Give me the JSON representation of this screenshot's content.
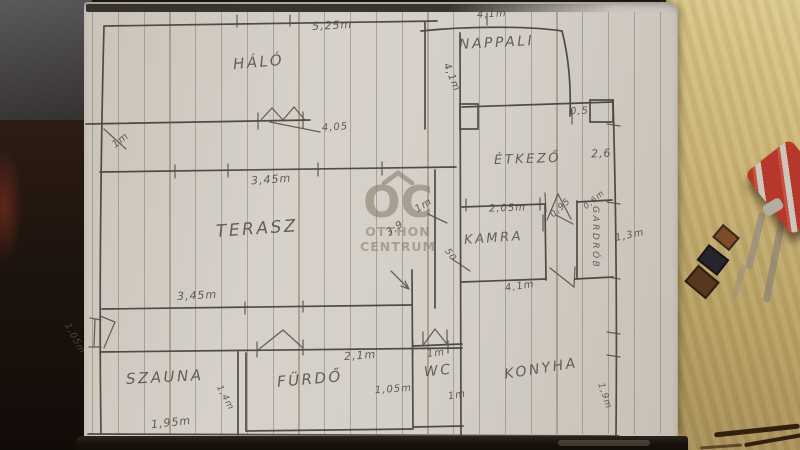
{
  "watermark": {
    "initials": "OC",
    "line1": "OTTHON",
    "line2": "CENTRUM",
    "color": "#87806f"
  },
  "plan": {
    "room_labels": [
      {
        "text": "HÁLÓ",
        "x": 233,
        "y": 55,
        "size": 15,
        "rot": -5
      },
      {
        "text": "NAPPALI",
        "x": 459,
        "y": 36,
        "size": 14,
        "rot": -3
      },
      {
        "text": "ÉTKEZŐ",
        "x": 494,
        "y": 153,
        "size": 13,
        "rot": -2
      },
      {
        "text": "TERASZ",
        "x": 216,
        "y": 221,
        "size": 17,
        "rot": -4
      },
      {
        "text": "KAMRA",
        "x": 464,
        "y": 232,
        "size": 13,
        "rot": -4
      },
      {
        "text": "KONYHA",
        "x": 504,
        "y": 362,
        "size": 14,
        "rot": -9
      },
      {
        "text": "SZAUNA",
        "x": 126,
        "y": 370,
        "size": 15,
        "rot": -3
      },
      {
        "text": "FÜRDŐ",
        "x": 277,
        "y": 372,
        "size": 15,
        "rot": -5
      },
      {
        "text": "WC",
        "x": 424,
        "y": 364,
        "size": 14,
        "rot": -6
      },
      {
        "text": "GARDRÓB",
        "x": 599,
        "y": 206,
        "size": 9,
        "rot": 90,
        "origin": "0 0"
      }
    ],
    "dimension_labels": [
      {
        "text": "5,25m",
        "x": 312,
        "y": 20,
        "size": 11,
        "rot": -3
      },
      {
        "text": "4,1m",
        "x": 477,
        "y": 10,
        "size": 10,
        "rot": -3
      },
      {
        "text": "4,1m",
        "x": 450,
        "y": 62,
        "size": 10,
        "rot": 68,
        "origin": "0 0"
      },
      {
        "text": "0,5",
        "x": 570,
        "y": 107,
        "size": 10,
        "rot": -2
      },
      {
        "text": "1m",
        "x": 112,
        "y": 136,
        "size": 10,
        "rot": -38
      },
      {
        "text": "4,05",
        "x": 322,
        "y": 123,
        "size": 10,
        "rot": -4
      },
      {
        "text": "3,45m",
        "x": 251,
        "y": 174,
        "size": 11,
        "rot": -4
      },
      {
        "text": "2,6",
        "x": 591,
        "y": 148,
        "size": 11,
        "rot": -3
      },
      {
        "text": "1m",
        "x": 415,
        "y": 201,
        "size": 10,
        "rot": -32
      },
      {
        "text": "2,05m",
        "x": 489,
        "y": 204,
        "size": 10,
        "rot": -2
      },
      {
        "text": "0,95",
        "x": 549,
        "y": 204,
        "size": 9,
        "rot": -42
      },
      {
        "text": "0,6m",
        "x": 582,
        "y": 196,
        "size": 8,
        "rot": -40
      },
      {
        "text": "1,3m",
        "x": 615,
        "y": 231,
        "size": 10,
        "rot": -12
      },
      {
        "text": "3,9",
        "x": 386,
        "y": 224,
        "size": 10,
        "rot": -35
      },
      {
        "text": "50",
        "x": 443,
        "y": 251,
        "size": 9,
        "rot": 55
      },
      {
        "text": "4,1m",
        "x": 505,
        "y": 282,
        "size": 10,
        "rot": -8
      },
      {
        "text": "3,45m",
        "x": 177,
        "y": 290,
        "size": 11,
        "rot": -3
      },
      {
        "text": "1,05m",
        "x": 70,
        "y": 322,
        "size": 9,
        "rot": 62,
        "origin": "0 0"
      },
      {
        "text": "1,4m",
        "x": 222,
        "y": 384,
        "size": 9,
        "rot": 62,
        "origin": "0 0"
      },
      {
        "text": "2,1m",
        "x": 344,
        "y": 350,
        "size": 11,
        "rot": -4
      },
      {
        "text": "1m",
        "x": 427,
        "y": 349,
        "size": 10,
        "rot": -6
      },
      {
        "text": "1,05m",
        "x": 375,
        "y": 385,
        "size": 10,
        "rot": -4
      },
      {
        "text": "1m",
        "x": 448,
        "y": 391,
        "size": 10,
        "rot": -10
      },
      {
        "text": "1,95m",
        "x": 151,
        "y": 417,
        "size": 11,
        "rot": -6
      },
      {
        "text": "1,9m",
        "x": 604,
        "y": 382,
        "size": 9,
        "rot": 72,
        "origin": "0 0"
      }
    ]
  },
  "palette": {
    "paper": "#d4cfc7",
    "ruling": "#a2998b",
    "ink": "#45403a",
    "pencil": "#57514a",
    "watermark": "#87806f",
    "fabric": "#c9b271",
    "notebook_edge": "#16120f",
    "red_object": "#b5382b",
    "diamond_rust": "#7e4a28",
    "diamond_dark": "#26242c",
    "diamond_brown": "#55381e"
  }
}
